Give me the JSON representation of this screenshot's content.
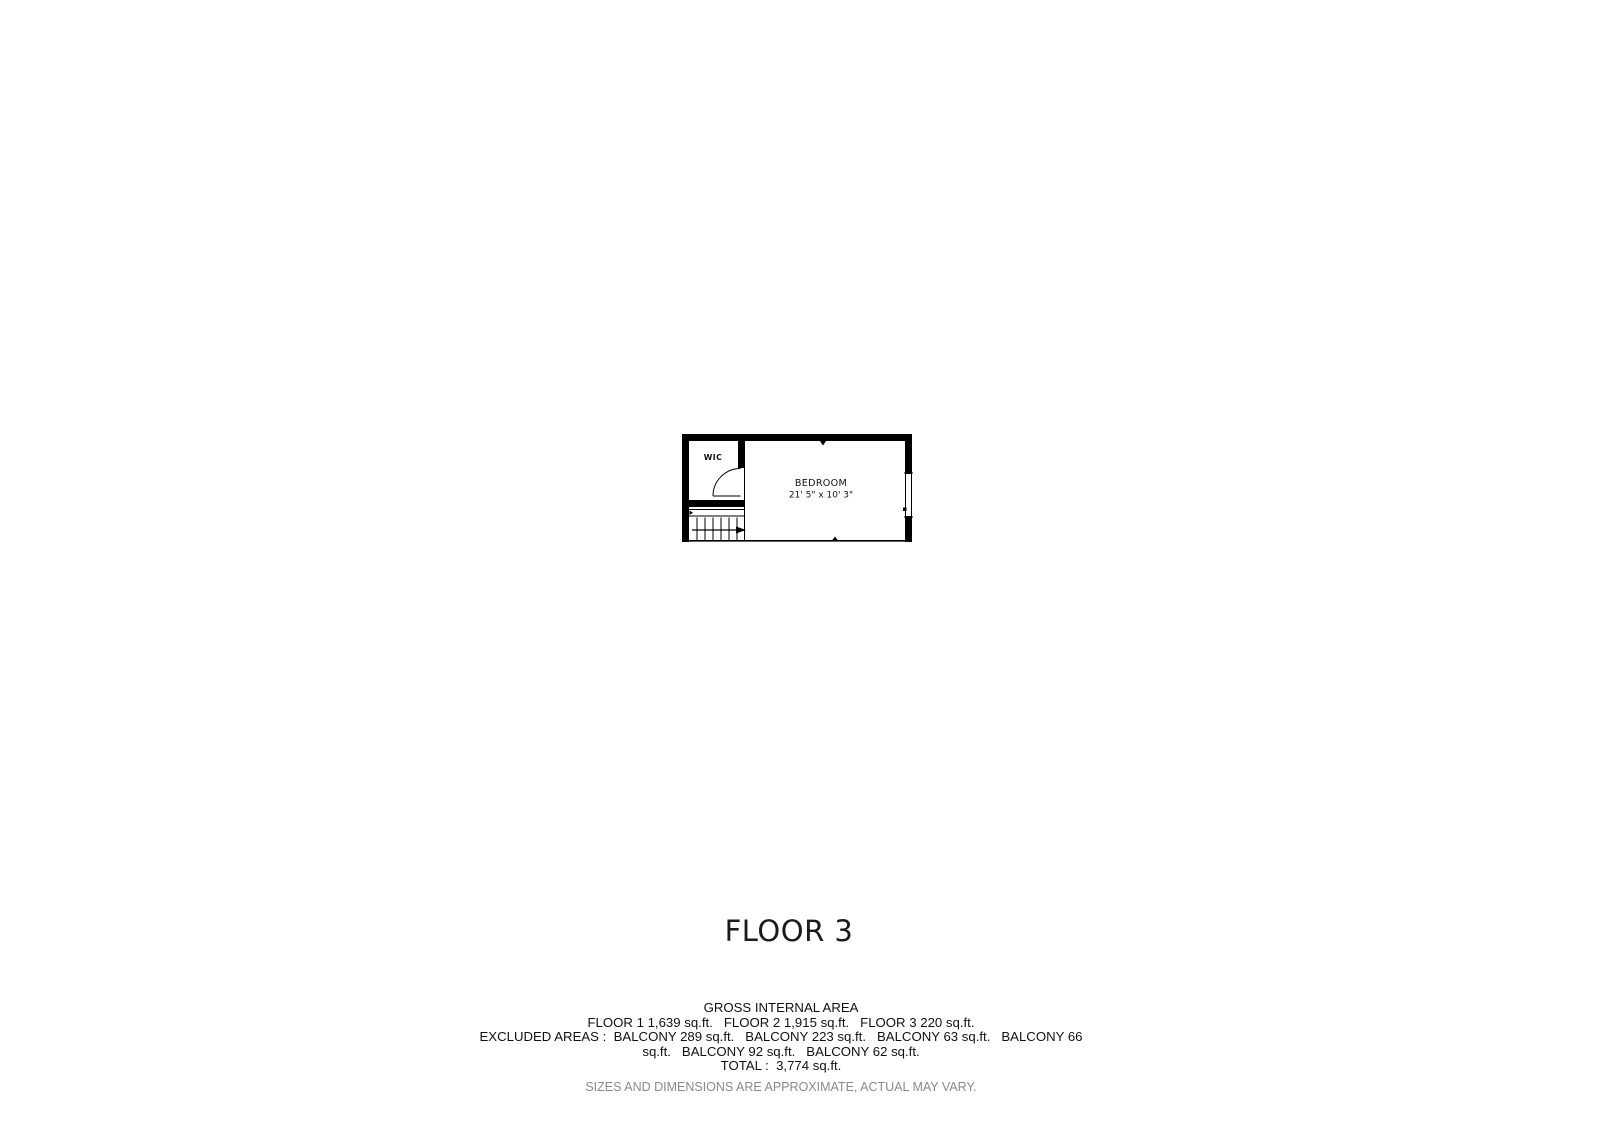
{
  "page": {
    "background": "#ffffff",
    "ink_color": "#000000"
  },
  "plan": {
    "rooms": {
      "wic": {
        "label": "WIC"
      },
      "bedroom": {
        "label": "BEDROOM",
        "dimensions": "21' 5\" x 10' 3\""
      }
    },
    "features": [
      "stairs",
      "door-swing",
      "window"
    ]
  },
  "title": {
    "label": "FLOOR 3"
  },
  "footer": {
    "heading": "GROSS INTERNAL AREA",
    "lines": [
      "GROSS INTERNAL AREA",
      "FLOOR 1 1,639 sq.ft.   FLOOR 2 1,915 sq.ft.   FLOOR 3 220 sq.ft.",
      "EXCLUDED AREAS :  BALCONY 289 sq.ft.   BALCONY 223 sq.ft.   BALCONY 63 sq.ft.   BALCONY 66",
      "sq.ft.   BALCONY 92 sq.ft.   BALCONY 62 sq.ft.",
      "TOTAL :  3,774 sq.ft."
    ],
    "disclaimer": "SIZES AND DIMENSIONS ARE APPROXIMATE, ACTUAL MAY VARY.",
    "disclaimer_color": "#8a8a8a"
  }
}
